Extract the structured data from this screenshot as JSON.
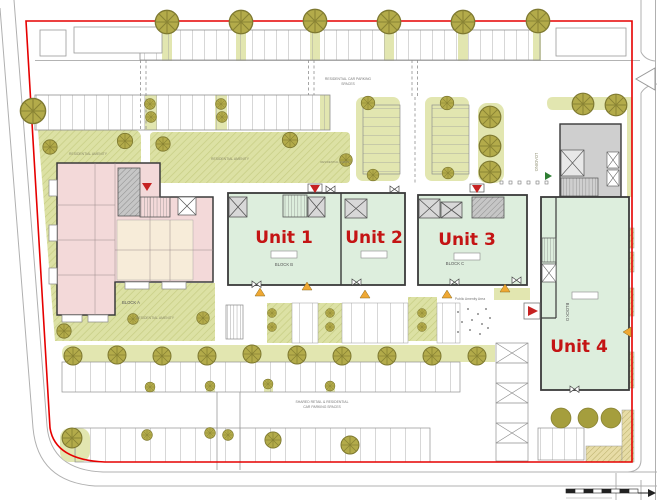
{
  "plan": {
    "units": {
      "unit1": "Unit 1",
      "unit2": "Unit 2",
      "unit3": "Unit 3",
      "unit4": "Unit 4"
    },
    "blocks": {
      "block_a": "BLOCK A",
      "block_b": "BLOCK B",
      "block_c": "BLOCK C",
      "block_d": "BLOCK D"
    },
    "labels": {
      "residential_amenity": "RESIDENTIAL AMENITY",
      "loading": "LOADING",
      "public_amenity": "Public Amenity Area",
      "residential_parking_line1": "RESIDENTIAL CAR PARKING",
      "residential_parking_line2": "SPACES",
      "shared_parking_line1": "SHARED RETAIL & RESIDENTIAL",
      "shared_parking_line2": "CAR PARKING SPACES"
    },
    "colors": {
      "boundary": "#e60000",
      "unit_floor": "#ddeedd",
      "unit_label": "#c41414",
      "amenity_green": "#dce1a4",
      "verge_green": "#e2e6b0",
      "tree": "#b3ab4a",
      "block_a_fill": "#f3d9d9"
    }
  }
}
